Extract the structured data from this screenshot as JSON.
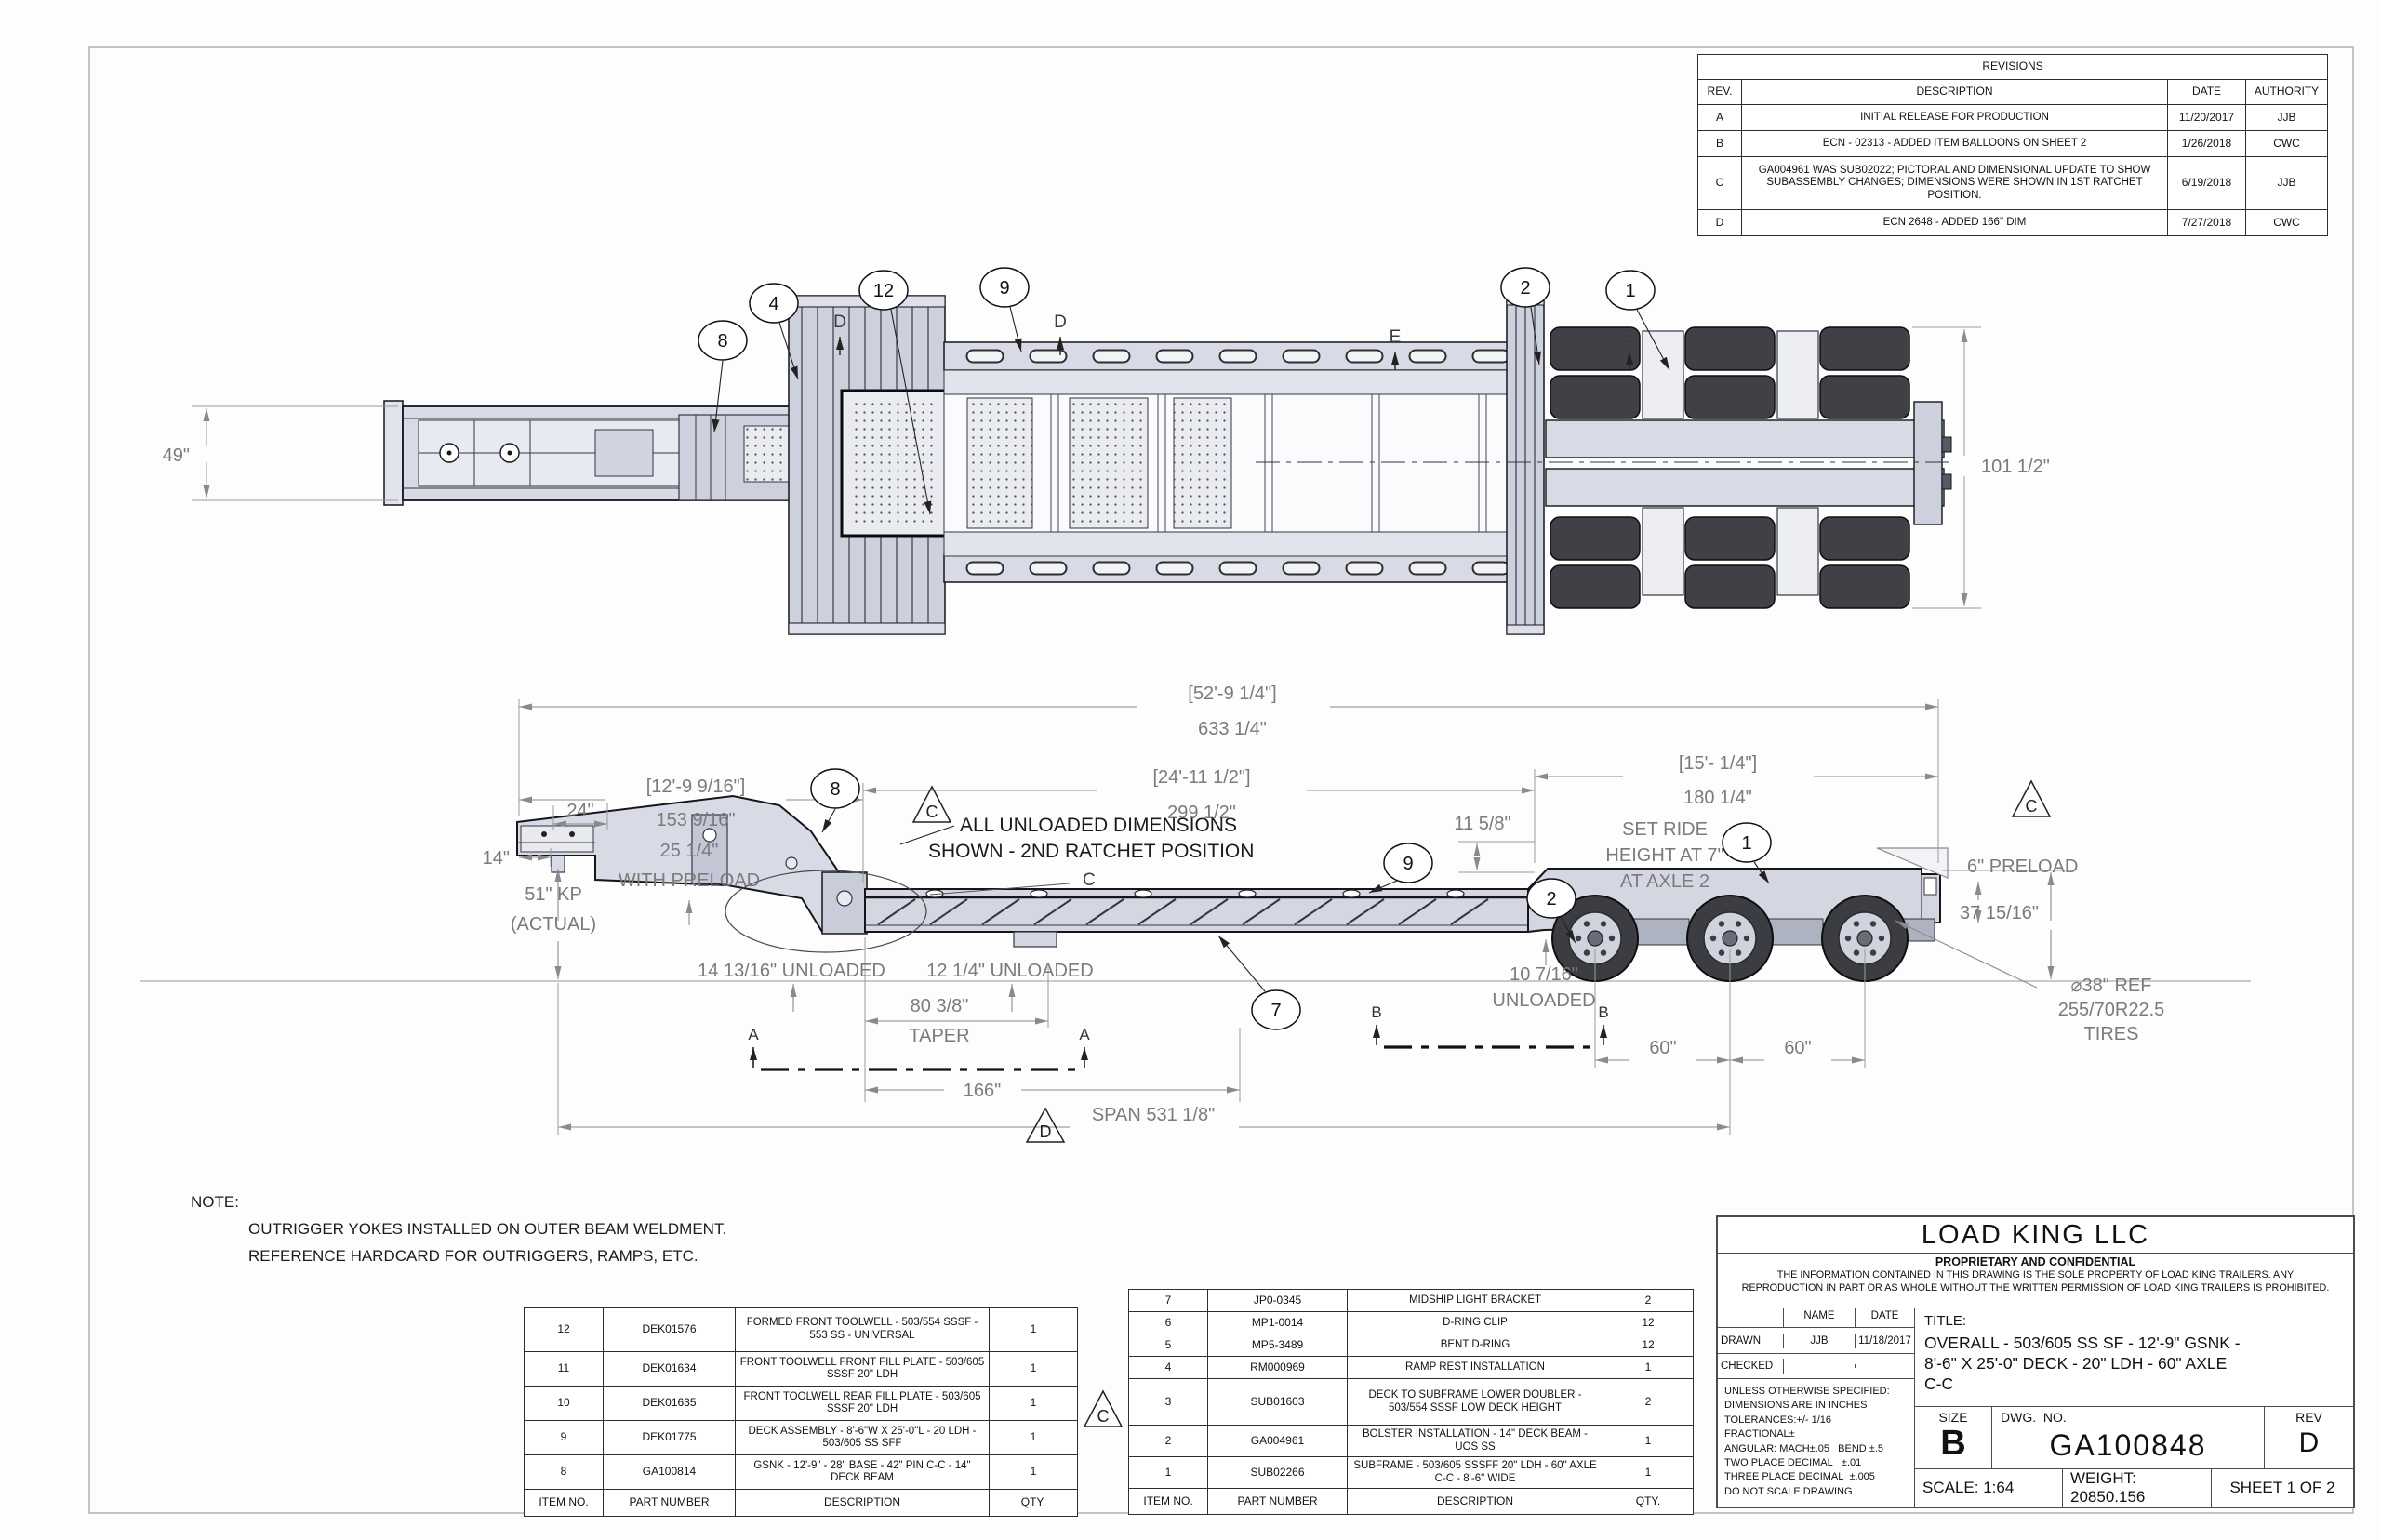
{
  "colors": {
    "body_fill": "#d8dbe6",
    "body_fill2": "#c7cbd9",
    "outline": "#15151a",
    "dim_gray": "#7b7b7b",
    "tire_dark": "#3b3d43",
    "rim_light": "#d0d3de"
  },
  "revisions": {
    "title": "REVISIONS",
    "headers": [
      "REV.",
      "DESCRIPTION",
      "DATE",
      "AUTHORITY"
    ],
    "rows": [
      [
        "A",
        "INITIAL RELEASE FOR PRODUCTION",
        "11/20/2017",
        "JJB"
      ],
      [
        "B",
        "ECN - 02313  -  ADDED ITEM BALLOONS ON SHEET 2",
        "1/26/2018",
        "CWC"
      ],
      [
        "C",
        "GA004961 WAS SUB02022; PICTORAL AND DIMENSIONAL UPDATE TO SHOW SUBASSEMBLY CHANGES; DIMENSIONS WERE SHOWN IN 1ST RATCHET POSITION.",
        "6/19/2018",
        "JJB"
      ],
      [
        "D",
        "ECN 2648 - ADDED 166\" DIM",
        "7/27/2018",
        "CWC"
      ]
    ]
  },
  "note": {
    "label": "NOTE:",
    "lines": [
      "OUTRIGGER YOKES INSTALLED ON OUTER BEAM WELDMENT.",
      "REFERENCE HARDCARD FOR OUTRIGGERS, RAMPS, ETC."
    ]
  },
  "parts_left": {
    "headers": [
      "ITEM NO.",
      "PART NUMBER",
      "DESCRIPTION",
      "QTY."
    ],
    "rows": [
      [
        "12",
        "DEK01576",
        "FORMED FRONT TOOLWELL - 503/554 SSSF - 553 SS - UNIVERSAL",
        "1"
      ],
      [
        "11",
        "DEK01634",
        "FRONT TOOLWELL FRONT FILL PLATE - 503/605 SSSF 20\" LDH",
        "1"
      ],
      [
        "10",
        "DEK01635",
        "FRONT TOOLWELL REAR FILL PLATE - 503/605 SSSF 20\" LDH",
        "1"
      ],
      [
        "9",
        "DEK01775",
        "DECK ASSEMBLY - 8'-6\"W X 25'-0\"L - 20 LDH - 503/605 SS SFF",
        "1"
      ],
      [
        "8",
        "GA100814",
        "GSNK - 12'-9\" - 28\" BASE - 42\" PIN C-C - 14\" DECK BEAM",
        "1"
      ]
    ]
  },
  "parts_right": {
    "headers": [
      "ITEM NO.",
      "PART NUMBER",
      "DESCRIPTION",
      "QTY."
    ],
    "rows": [
      [
        "7",
        "JP0-0345",
        "MIDSHIP LIGHT BRACKET",
        "2"
      ],
      [
        "6",
        "MP1-0014",
        "D-RING CLIP",
        "12"
      ],
      [
        "5",
        "MP5-3489",
        "BENT D-RING",
        "12"
      ],
      [
        "4",
        "RM000969",
        "RAMP REST INSTALLATION",
        "1"
      ],
      [
        "3",
        "SUB01603",
        "DECK TO SUBFRAME LOWER DOUBLER - 503/554 SSSF LOW DECK HEIGHT",
        "2"
      ],
      [
        "2",
        "GA004961",
        "BOLSTER INSTALLATION - 14\" DECK BEAM - UOS SS",
        "1"
      ],
      [
        "1",
        "SUB02266",
        "SUBFRAME - 503/605 SSSFF 20\" LDH - 60\" AXLE C-C - 8'-6\" WIDE",
        "1"
      ]
    ]
  },
  "title_block": {
    "company": "LOAD KING LLC",
    "conf_title": "PROPRIETARY AND CONFIDENTIAL",
    "conf_line1": "THE INFORMATION CONTAINED IN THIS DRAWING IS THE SOLE PROPERTY OF LOAD KING TRAILERS. ANY",
    "conf_line2": "REPRODUCTION IN PART OR AS WHOLE WITHOUT THE WRITTEN PERMISSION OF LOAD KING TRAILERS IS PROHIBITED.",
    "name_header": "NAME",
    "date_header": "DATE",
    "drawn_label": "DRAWN",
    "drawn_name": "JJB",
    "drawn_date": "11/18/2017",
    "checked_label": "CHECKED",
    "tolerances": [
      "UNLESS OTHERWISE SPECIFIED:",
      "DIMENSIONS ARE IN INCHES",
      "TOLERANCES:+/- 1/16",
      "FRACTIONAL±",
      "ANGULAR: MACH±.05   BEND ±.5",
      "TWO PLACE DECIMAL   ±.01",
      "THREE PLACE DECIMAL  ±.005",
      "DO NOT SCALE DRAWING"
    ],
    "title_label": "TITLE:",
    "title_line1": "OVERALL - 503/605 SS SF - 12'-9\" GSNK -",
    "title_line2": "8'-6\" X 25'-0\" DECK  - 20\" LDH - 60\" AXLE",
    "title_line3": "C-C",
    "size_label": "SIZE",
    "size_value": "B",
    "dwg_label": "DWG.  NO.",
    "dwg_value": "GA100848",
    "rev_label": "REV",
    "rev_value": "D",
    "scale": "SCALE: 1:64",
    "weight": "WEIGHT: 20850.156",
    "sheet": "SHEET 1 OF 2"
  },
  "top": {
    "dims": {
      "front_width": "49\"",
      "rear_width": "101 1/2\""
    },
    "balloons": [
      "8",
      "4",
      "12",
      "9",
      "2",
      "1"
    ]
  },
  "side": {
    "dims": {
      "overall_ft": "[52'-9 1/4\"]",
      "overall_in": "633 1/4\"",
      "gsnk_ft": "[12'-9 9/16\"]",
      "gsnk_in": "153 9/16\"",
      "deck_ft": "[24'-11 1/2\"]",
      "deck_in": "299 1/2\"",
      "rear_ft": "[15'- 1/4\"]",
      "rear_in": "180 1/4\"",
      "front24": "24\"",
      "front14": "14\"",
      "preload_a": "25 1/4\"",
      "preload_b": "WITH PRELOAD",
      "kp_a": "51\" KP",
      "kp_b": "(ACTUAL)",
      "unloaded_front": "14 13/16\" UNLOADED",
      "unloaded_mid": "12 1/4\" UNLOADED",
      "taper_a": "80 3/8\"",
      "taper_b": "TAPER",
      "len166": "166\"",
      "span": "SPAN 531 1/8\"",
      "axle60_1": "60\"",
      "axle60_2": "60\"",
      "height37": "37 15/16\"",
      "step11": "11 5/8\"",
      "unloaded_rear_a": "10 7/16\"",
      "unloaded_rear_b": "UNLOADED",
      "preload6": "6\" PRELOAD",
      "ride_a": "SET RIDE",
      "ride_b": "HEIGHT AT 7\"",
      "ride_c": "AT AXLE 2",
      "tires_a": "⌀38\" REF",
      "tires_b": "255/70R22.5",
      "tires_c": "TIRES"
    },
    "note": [
      "ALL UNLOADED DIMENSIONS",
      "SHOWN - 2ND RATCHET POSITION"
    ],
    "balloons": [
      "8",
      "9",
      "7",
      "2",
      "1"
    ]
  },
  "sections": {
    "a": "A",
    "b": "B",
    "c": "C",
    "d": "D",
    "e": "E"
  },
  "flags": {
    "c": "C",
    "d": "D"
  }
}
